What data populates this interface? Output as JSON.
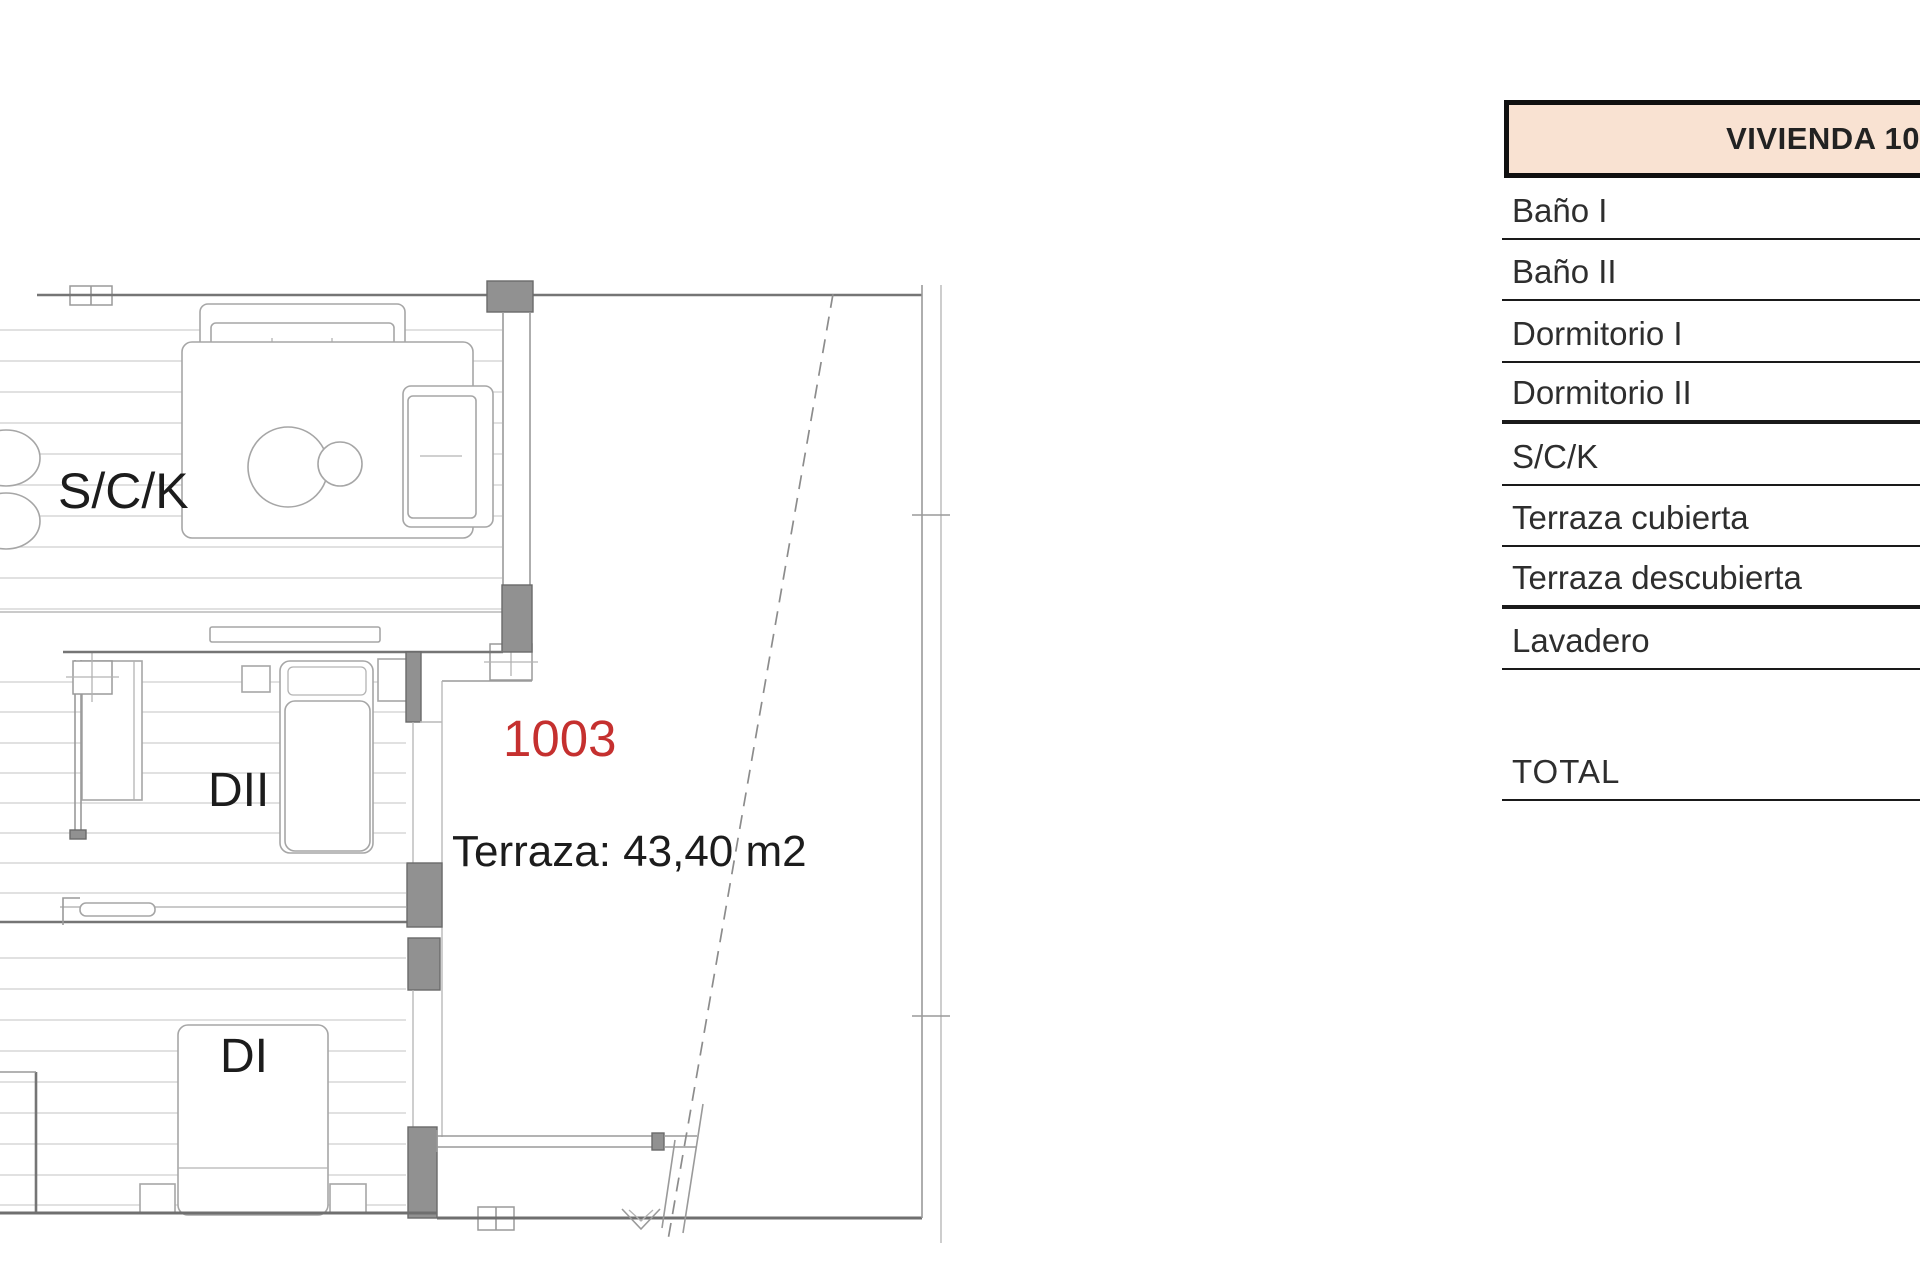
{
  "plan": {
    "rooms": {
      "sck_label": "S/C/K",
      "dormitorio2_label": "DII",
      "dormitorio1_label": "DI"
    },
    "unit": {
      "number": "1003",
      "number_color": "#c5302f"
    },
    "terrace": {
      "area_label": "Terraza: 43,40 m2"
    }
  },
  "table": {
    "header": {
      "title": "VIVIENDA 10",
      "fill": "#f9e2d2",
      "border_color": "#101010"
    },
    "rows": [
      {
        "label": "Baño I",
        "thick": false
      },
      {
        "label": "Baño II",
        "thick": false
      },
      {
        "label": "Dormitorio I",
        "thick": false
      },
      {
        "label": "Dormitorio II",
        "thick": true
      },
      {
        "label": "S/C/K",
        "thick": false
      },
      {
        "label": "Terraza cubierta",
        "thick": false
      },
      {
        "label": "Terraza descubierta",
        "thick": true
      },
      {
        "label": "Lavadero",
        "thick": false
      }
    ],
    "total_label": "TOTAL"
  }
}
